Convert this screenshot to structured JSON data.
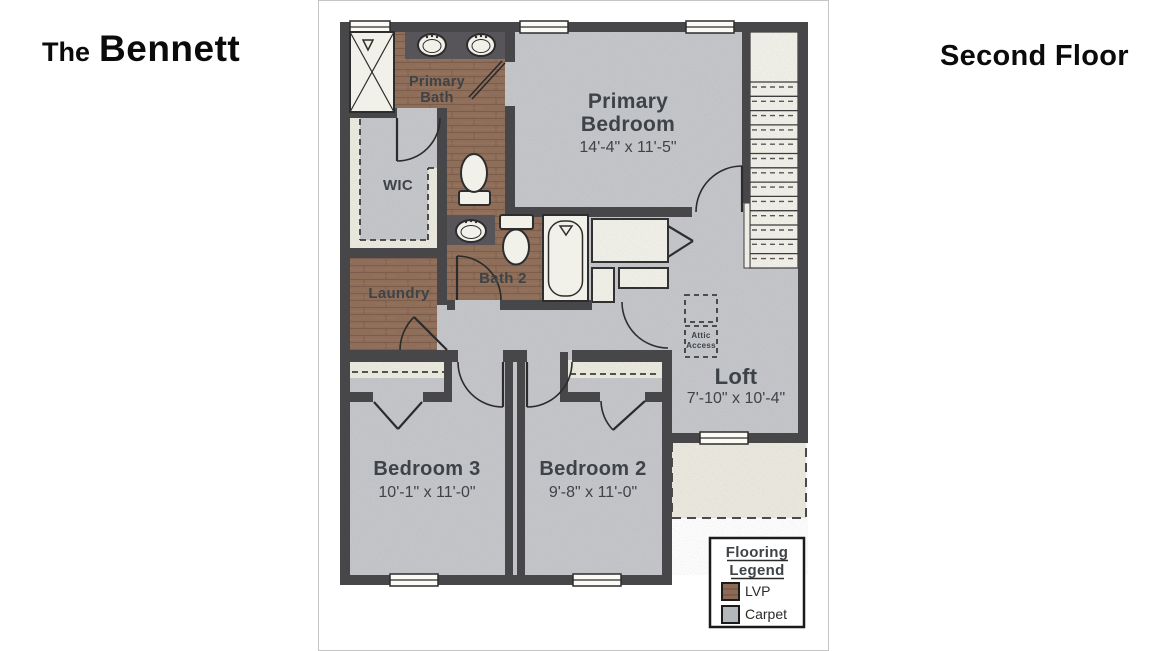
{
  "titles": {
    "left_prefix": "The",
    "left_name": "Bennett",
    "right": "Second Floor"
  },
  "rooms": {
    "primary_bath": {
      "line1": "Primary",
      "line2": "Bath"
    },
    "primary_bedroom": {
      "line1": "Primary",
      "line2": "Bedroom",
      "dims": "14'-4\" x 11'-5\""
    },
    "wic": {
      "label": "WIC"
    },
    "bath2": {
      "label": "Bath 2"
    },
    "laundry": {
      "label": "Laundry"
    },
    "attic_access": {
      "line1": "Attic",
      "line2": "Access"
    },
    "loft": {
      "label": "Loft",
      "dims": "7'-10\" x 10'-4\""
    },
    "bedroom3": {
      "label": "Bedroom 3",
      "dims": "10'-1\" x 11'-0\""
    },
    "bedroom2": {
      "label": "Bedroom 2",
      "dims": "9'-8\" x 11'-0\""
    }
  },
  "legend": {
    "title_line1": "Flooring",
    "title_line2": "Legend",
    "items": [
      {
        "label": "LVP",
        "color": "#8c6a55"
      },
      {
        "label": "Carpet",
        "color": "#b4b8bc"
      }
    ]
  },
  "colors": {
    "wall": "#47474a",
    "carpet": "#c5c6ca",
    "lvp": "#8f6d57",
    "counter": "#57555a",
    "fixture": "#f2f1e9",
    "cream": "#ecebdf",
    "label_text": "#3e4347"
  }
}
